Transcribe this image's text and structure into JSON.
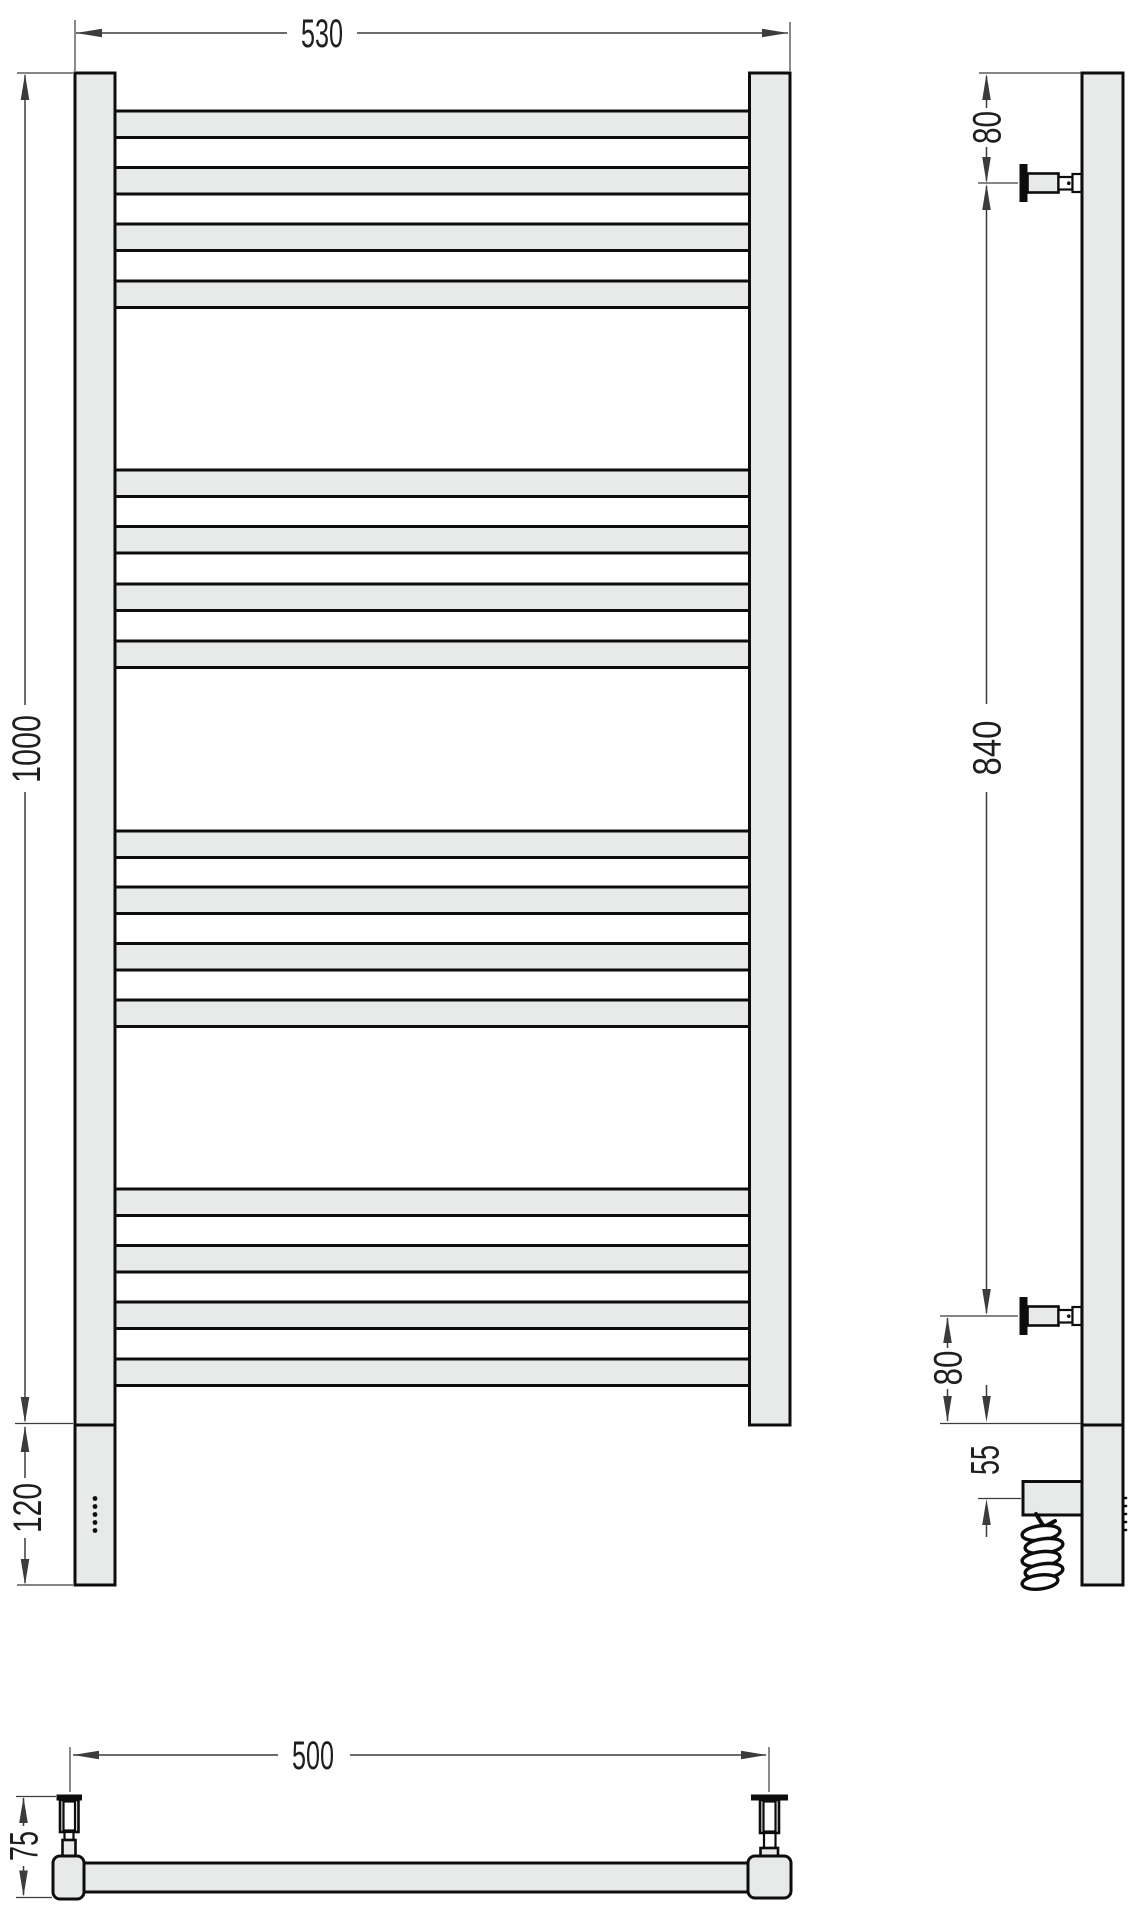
{
  "labels": {
    "front_width": "530",
    "front_height": "1000",
    "front_bottom_section": "120",
    "side_top_bracket_offset": "80",
    "side_bracket_span": "840",
    "side_bottom_bracket_offset": "80",
    "side_heater_offset": "55",
    "plan_bracket_spacing": "500",
    "plan_depth": "75"
  },
  "colors": {
    "metal_fill": "#e8e9e9",
    "outline": "#0d0d0d",
    "dimension_line": "#3c3c3c",
    "label_text": "#1f1f1f",
    "background": "#ffffff"
  },
  "front_view": {
    "rung_groups": 4,
    "rungs_per_group": 4,
    "control_dots": 5
  },
  "side_view": {
    "wall_brackets": 2,
    "has_heater_box": true,
    "has_coiled_cable": true
  }
}
